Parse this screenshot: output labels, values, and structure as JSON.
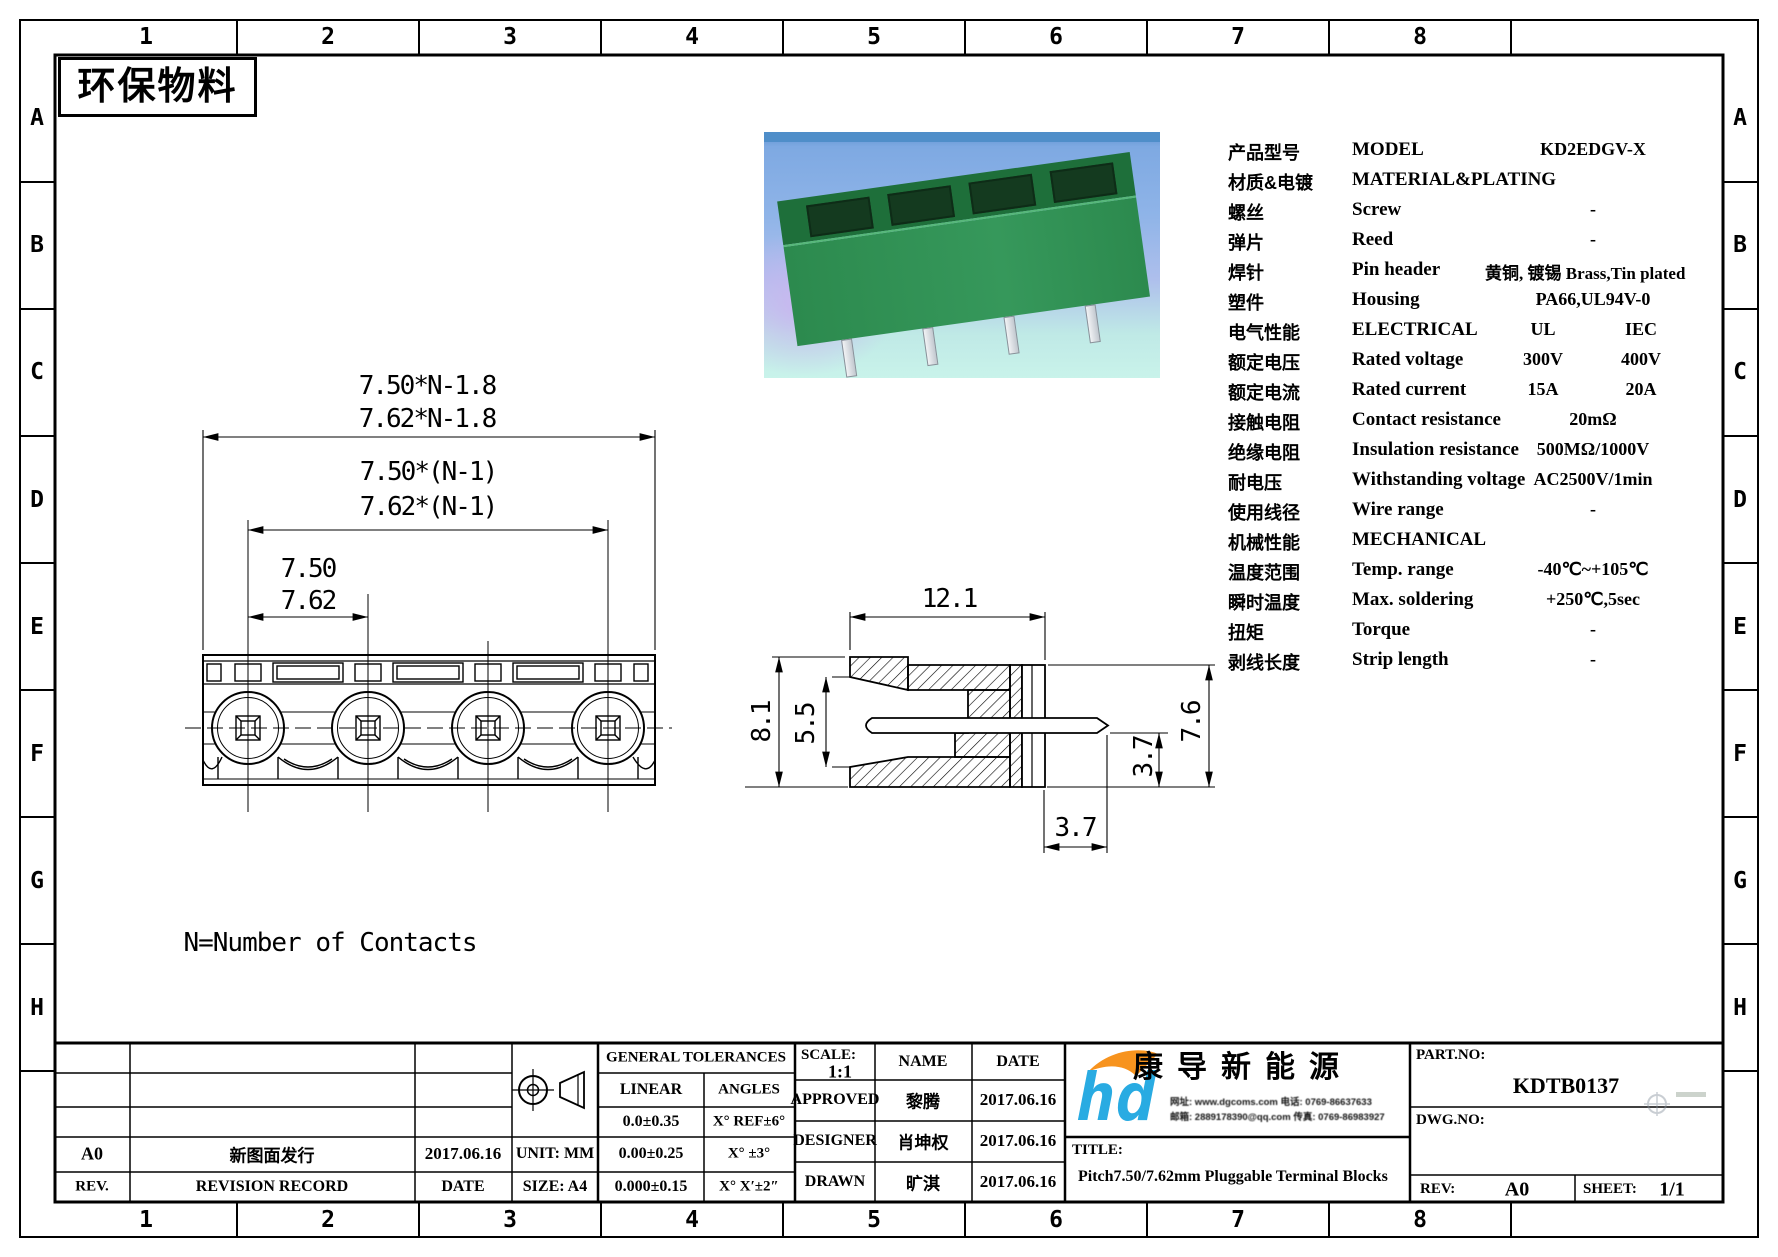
{
  "sheet": {
    "stamp": "环保物料",
    "note": "N=Number of Contacts"
  },
  "border": {
    "cols": [
      "1",
      "2",
      "3",
      "4",
      "5",
      "6",
      "7",
      "8"
    ],
    "rows": [
      "A",
      "B",
      "C",
      "D",
      "E",
      "F",
      "G",
      "H"
    ]
  },
  "photo": {
    "description": "green-pluggable-terminal-block-render",
    "colors": {
      "body_green": "#2c8a4e",
      "top_green": "#1e6f3a",
      "sky_blue": "#8fb4e8",
      "lavender": "#c9b5f0",
      "cyan": "#c9f3ea"
    }
  },
  "spec": {
    "rows": [
      {
        "cn": "产品型号",
        "en": "MODEL",
        "v": "KD2EDGV-X"
      },
      {
        "cn": "材质&电镀",
        "en": "MATERIAL&PLATING",
        "v": ""
      },
      {
        "cn": "螺丝",
        "en": "Screw",
        "v": "-"
      },
      {
        "cn": "弹片",
        "en": "Reed",
        "v": "-"
      },
      {
        "cn": "焊针",
        "en": "Pin header",
        "v": "黄铜, 镀锡 Brass,Tin plated"
      },
      {
        "cn": "塑件",
        "en": "Housing",
        "v": "PA66,UL94V-0"
      },
      {
        "cn": "电气性能",
        "en": "ELECTRICAL",
        "a": "UL",
        "b": "IEC"
      },
      {
        "cn": "额定电压",
        "en": "Rated voltage",
        "a": "300V",
        "b": "400V"
      },
      {
        "cn": "额定电流",
        "en": "Rated current",
        "a": "15A",
        "b": "20A"
      },
      {
        "cn": "接触电阻",
        "en": "Contact resistance",
        "v": "20mΩ"
      },
      {
        "cn": "绝缘电阻",
        "en": "Insulation resistance",
        "v": "500MΩ/1000V"
      },
      {
        "cn": "耐电压",
        "en": "Withstanding voltage",
        "v": "AC2500V/1min"
      },
      {
        "cn": "使用线径",
        "en": "Wire range",
        "v": "-"
      },
      {
        "cn": "机械性能",
        "en": "MECHANICAL",
        "v": ""
      },
      {
        "cn": "温度范围",
        "en": "Temp. range",
        "v": "-40℃~+105℃"
      },
      {
        "cn": "瞬时温度",
        "en": "Max. soldering",
        "v": "+250℃,5sec"
      },
      {
        "cn": "扭矩",
        "en": "Torque",
        "v": "-"
      },
      {
        "cn": "剥线长度",
        "en": "Strip length",
        "v": "-"
      }
    ]
  },
  "front_view": {
    "d1a": "7.50*N-1.8",
    "d1b": "7.62*N-1.8",
    "d2a": "7.50*(N-1)",
    "d2b": "7.62*(N-1)",
    "d3a": "7.50",
    "d3b": "7.62"
  },
  "side_view": {
    "top": "12.1",
    "left": "8.1",
    "inner_left": "5.5",
    "right": "7.6",
    "inner_right": "3.7",
    "bottom": "3.7"
  },
  "title_block": {
    "revision": {
      "rev_hdr": "REV.",
      "record_hdr": "REVISION RECORD",
      "date_hdr": "DATE",
      "row": {
        "rev": "A0",
        "record": "新图面发行",
        "date": "2017.06.16"
      }
    },
    "unit": "UNIT: MM",
    "size": "SIZE: A4",
    "tolerances": {
      "title": "GENERAL TOLERANCES",
      "linear": "LINEAR",
      "angles": "ANGLES",
      "rows": [
        [
          "0.0±0.35",
          "X° REF±6°"
        ],
        [
          "0.00±0.25",
          "X° ±3°"
        ],
        [
          "0.000±0.15",
          "X° X′±2″"
        ]
      ]
    },
    "approval": {
      "scale_label": "SCALE:",
      "scale": "1:1",
      "name_hdr": "NAME",
      "date_hdr": "DATE",
      "rows": [
        {
          "role": "APPROVED",
          "name": "黎腾",
          "date": "2017.06.16"
        },
        {
          "role": "DESIGNER",
          "name": "肖坤权",
          "date": "2017.06.16"
        },
        {
          "role": "DRAWN",
          "name": "旷淇",
          "date": "2017.06.16"
        }
      ]
    },
    "company": {
      "name": "康导新能源",
      "contact1": "网址: www.dgcoms.com  电话: 0769-86637633",
      "contact2": "邮箱: 2889178390@qq.com 传真: 0769-86983927"
    },
    "title_label": "TITLE:",
    "title": "Pitch7.50/7.62mm Pluggable Terminal Blocks",
    "part_no_label": "PART.NO:",
    "part_no": "KDTB0137",
    "dwg_no_label": "DWG.NO:",
    "rev_label": "REV:",
    "rev": "A0",
    "sheet_label": "SHEET:",
    "sheet": "1/1"
  }
}
